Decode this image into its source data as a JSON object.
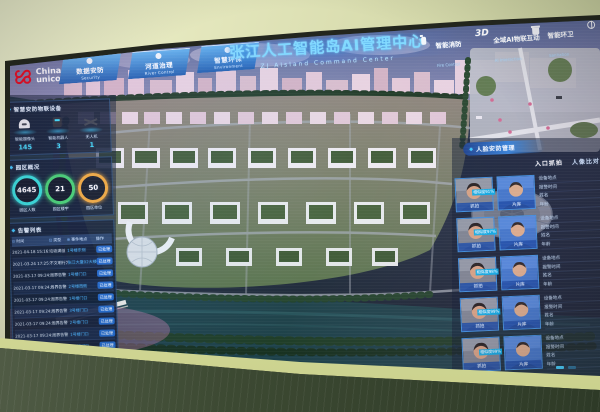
{
  "window": {
    "title_cn": "张江人工智能岛AI管理中心",
    "title_en": "ZJ AIsland Command Center"
  },
  "brand": {
    "line1": "China",
    "line2": "unicom",
    "cn": "中国联通"
  },
  "icons": {
    "diamond": "◆"
  },
  "colors": {
    "accent_cyan": "#35c8ff",
    "ring_cyan": "#2de0dc",
    "ring_green": "#3ed06e",
    "ring_orange": "#f0a838",
    "action_blue": "#1e66c8"
  },
  "nav_left": [
    {
      "label": "数据安防",
      "sub": "Security"
    },
    {
      "label": "河道治理",
      "sub": "River Control"
    },
    {
      "label": "智慧环保",
      "sub": "Environment"
    }
  ],
  "nav_right": [
    {
      "prefix": "",
      "label": "智能消防",
      "sub": "Fire Control",
      "icon": "fire-extinguisher-icon"
    },
    {
      "prefix": "3D",
      "label": "全域AI物联互动",
      "sub": "AI Interaction",
      "icon": ""
    },
    {
      "prefix": "",
      "label": "智能环卫",
      "sub": "Sanitation",
      "icon": "trash-bin-icon"
    },
    {
      "prefix": "",
      "label": "一网统管",
      "sub": "Manage",
      "icon": "grid-globe-icon"
    }
  ],
  "devices": {
    "header": "智慧安防物联设备",
    "items": [
      {
        "label": "智能摄像头",
        "count": "145",
        "icon": "dome-camera-icon"
      },
      {
        "label": "智能机器人",
        "count": "3",
        "icon": "robot-icon"
      },
      {
        "label": "无人机",
        "count": "1",
        "icon": "drone-icon"
      }
    ]
  },
  "overview": {
    "header": "园区概况",
    "stats": [
      {
        "value": "4645",
        "label": "园区人数",
        "color": "#2de0dc"
      },
      {
        "value": "21",
        "label": "园区楼宇",
        "color": "#3ed06e"
      },
      {
        "value": "50",
        "label": "园区单位",
        "color": "#f0a838"
      }
    ]
  },
  "alarms": {
    "header": "告警列表",
    "columns": [
      "时间",
      "类型",
      "事件地点",
      "操作"
    ],
    "column_icons": [
      "⊙",
      "⊡",
      "⊕",
      ""
    ],
    "rows": [
      {
        "time": "2021-04-18 15:16:01",
        "type": "垃圾满溢",
        "place": "1号楼东侧",
        "action": "已处理"
      },
      {
        "time": "2021-03-24 17:25:02",
        "type": "不文明行为",
        "place": "张江大厦02大楼",
        "action": "已处理"
      },
      {
        "time": "2021-03-17 09:24:35",
        "type": "周界告警",
        "place": "1号楼门口",
        "action": "已处理"
      },
      {
        "time": "2021-03-17 09:24:33",
        "type": "周界告警",
        "place": "2号楼西侧",
        "action": "已处理"
      },
      {
        "time": "2021-03-17 09:24:31",
        "type": "周界告警",
        "place": "1号楼门口",
        "action": "已处理"
      },
      {
        "time": "2021-03-17 09:24:28",
        "type": "周界告警",
        "place": "3号楼门口",
        "action": "已处理"
      },
      {
        "time": "2021-03-17 09:24:26",
        "type": "周界告警",
        "place": "2号楼门口",
        "action": "已处理"
      },
      {
        "time": "2021-03-17 09:24:20",
        "type": "周界告警",
        "place": "1号楼门口",
        "action": "已处理"
      },
      {
        "time": "2021-03-17 09:23:56",
        "type": "周界告警",
        "place": "2号楼门口",
        "action": "已处理"
      }
    ]
  },
  "faces": {
    "header": "人脸安防管理",
    "tabs": [
      "入口抓拍",
      "人像比对"
    ],
    "capture_label": "抓拍",
    "library_label": "片库",
    "info_labels": [
      "设备地点",
      "报警时间",
      "姓名",
      "年龄"
    ],
    "rows": [
      {
        "similarity": "相似度91%"
      },
      {
        "similarity": "相似度97%"
      },
      {
        "similarity": "相似度98%"
      },
      {
        "similarity": "相似度99%"
      },
      {
        "similarity": "相似度99%"
      }
    ]
  }
}
